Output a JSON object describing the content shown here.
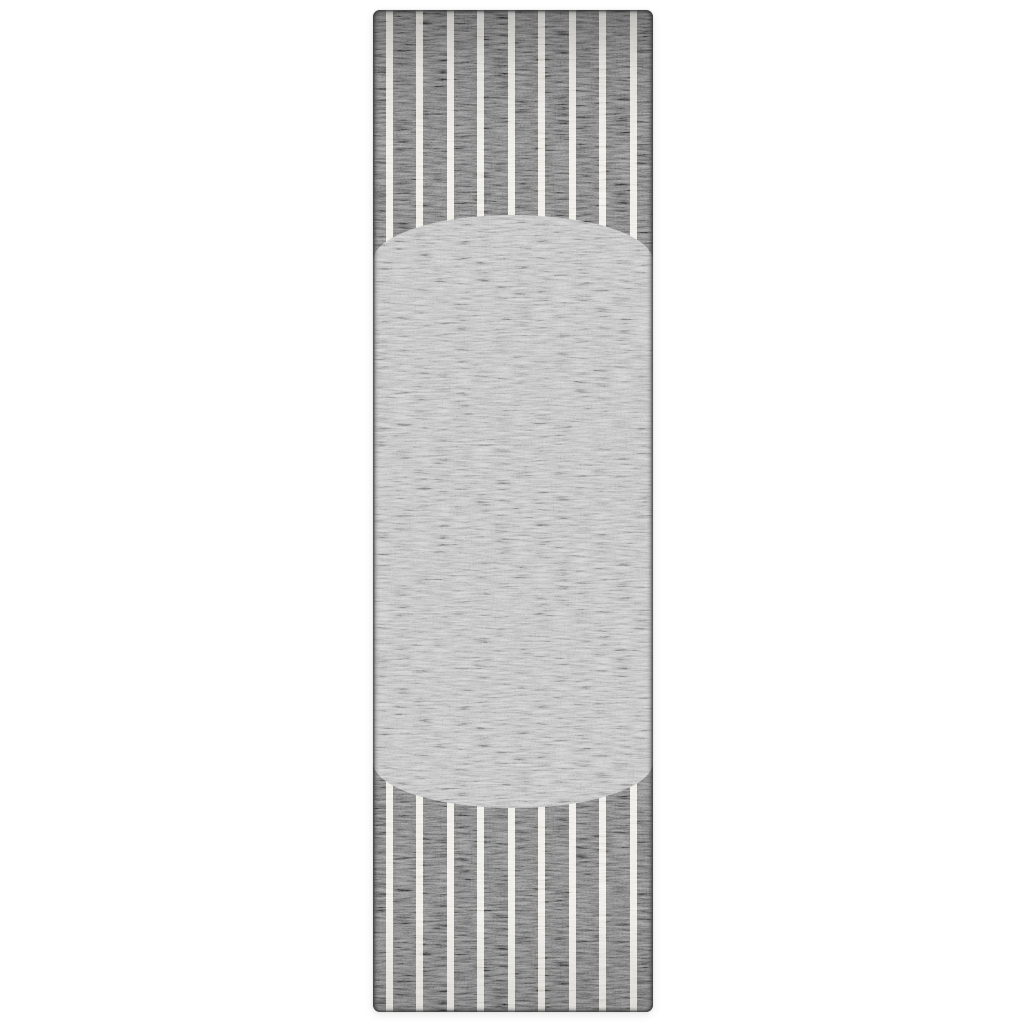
{
  "scene": {
    "description": "Studio product photo: gray heathered runner rug with thin off-white vertical pinstripes and a large light gray oval medallion spanning the rug center, on a plain white background",
    "background_color": "#ffffff"
  },
  "rug": {
    "position": {
      "left": 373,
      "top": 10,
      "width": 280,
      "height": 1002,
      "corner_radius": 7
    },
    "colors": {
      "field": "#6d6d6d",
      "field_dark_speckle": "#404040",
      "field_light_speckle": "#9d9d9d",
      "stripe": "#eae7e0",
      "medallion": "#b4b4b4",
      "edge_binding": "#585858"
    },
    "stripes": {
      "count": 9,
      "width": 7,
      "first_left": 12.5,
      "spacing": 30.5
    },
    "medallion": {
      "top": 205,
      "height": 593,
      "cap_vertical_radius": 46
    }
  }
}
